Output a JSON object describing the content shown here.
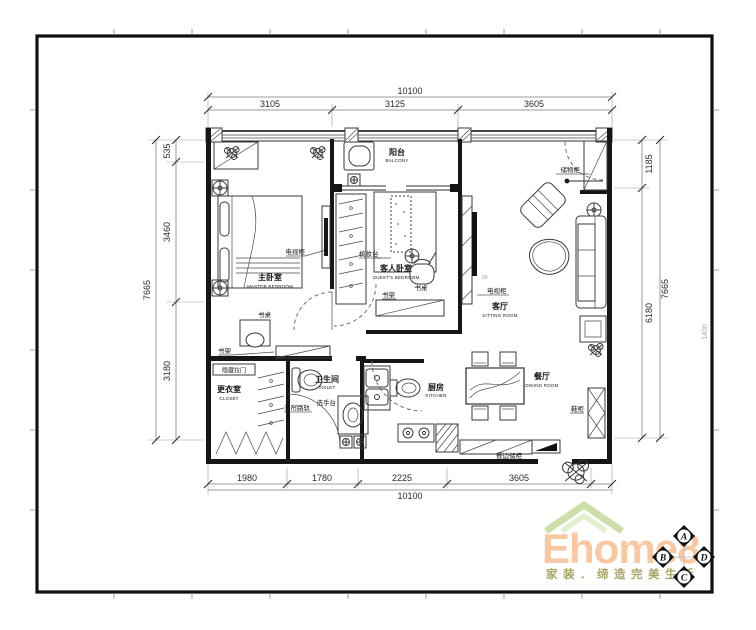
{
  "rooms": {
    "balcony": {
      "zh": "阳台",
      "en": "BALCONY"
    },
    "master_bedroom": {
      "zh": "主卧室",
      "en": "MASTER BEDROOM"
    },
    "guest_bedroom": {
      "zh": "客人卧室",
      "en": "GUEST'S BEDROOM"
    },
    "sitting_room": {
      "zh": "客厅",
      "en": "SITTING ROOM"
    },
    "toilet": {
      "zh": "卫生间",
      "en": "TOILET"
    },
    "closet": {
      "zh": "更衣室",
      "en": "CLOSET"
    },
    "kitchen": {
      "zh": "厨房",
      "en": "KITCHEN"
    },
    "dining_room": {
      "zh": "餐厅",
      "en": "DINING ROOM"
    }
  },
  "furniture": {
    "storage_cabinet": "储物柜",
    "tv_cabinet_master": "电视柜",
    "tv_cabinet_living": "电视柜",
    "wardrobe_label": "梳妆台",
    "desk_guest": "书桌",
    "bookshelf_guest": "书架",
    "desk_master": "书桌",
    "bookshelf_master": "书架",
    "hidden_sliding_door": "隐藏拉门",
    "shower_curtain_rail": "浴帘路轨",
    "wash_basin": "洗手台",
    "shoe_cabinet": "鞋柜",
    "sideboard": "餐边储柜",
    "tv_note": "00"
  },
  "dims": {
    "top": {
      "total": "10100",
      "s1": "3105",
      "s2": "3125",
      "s3": "3605"
    },
    "bottom": {
      "total": "10100",
      "s1": "1980",
      "s2": "1780",
      "s3": "2225",
      "s4": "3605"
    },
    "left": {
      "total": "7665",
      "s1": "535",
      "s2": "3460",
      "s3": "3180"
    },
    "right": {
      "total": "7665",
      "s1": "1185",
      "s2": "6180"
    }
  },
  "annotation": {
    "ruler": "1400"
  },
  "logo": {
    "brand": "Ehome8",
    "tagline": "家装．缔造完美生活"
  },
  "markers": {
    "top": "A",
    "left": "B",
    "bottom": "C",
    "right": "D"
  },
  "colors": {
    "logo_text": "#f9c7a2",
    "logo_roof": "#cddfa8",
    "tagline": "#a9a665"
  }
}
